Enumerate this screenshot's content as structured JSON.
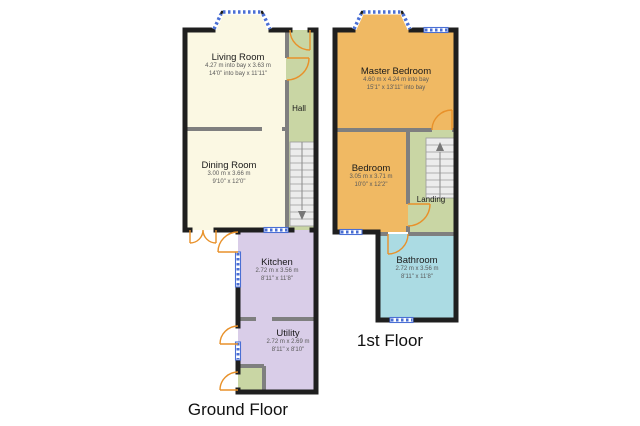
{
  "palette": {
    "room_cream": "#fbf8e3",
    "room_green": "#c9d6a4",
    "room_purple": "#d9cde8",
    "room_orange": "#f0b963",
    "room_blue": "#abdbe3",
    "wall_black": "#1f1f1f",
    "partition_gray": "#7f7f7f",
    "window_blue": "#4a6fd4",
    "door_orange": "#e8912a",
    "stairs_gray": "#ececec"
  },
  "floors": [
    {
      "title": "Ground Floor",
      "rooms": [
        {
          "name": "Living Room",
          "metric": "4.27 m into bay x 3.63 m",
          "imperial": "14'0\" into bay x 11'11\""
        },
        {
          "name": "Dining Room",
          "metric": "3.00 m x 3.66 m",
          "imperial": "9'10\" x 12'0\""
        },
        {
          "name": "Hall"
        },
        {
          "name": "Kitchen",
          "metric": "2.72 m x 3.56 m",
          "imperial": "8'11\" x 11'8\""
        },
        {
          "name": "Utility",
          "metric": "2.72 m x 2.69 m",
          "imperial": "8'11\" x 8'10\""
        }
      ]
    },
    {
      "title": "1st Floor",
      "rooms": [
        {
          "name": "Master Bedroom",
          "metric": "4.60 m x 4.24 m into bay",
          "imperial": "15'1\" x 13'11\" into bay"
        },
        {
          "name": "Bedroom",
          "metric": "3.05 m x 3.71 m",
          "imperial": "10'0\" x 12'2\""
        },
        {
          "name": "Landing"
        },
        {
          "name": "Bathroom",
          "metric": "2.72 m x 3.56 m",
          "imperial": "8'11\" x 11'8\""
        }
      ]
    }
  ]
}
